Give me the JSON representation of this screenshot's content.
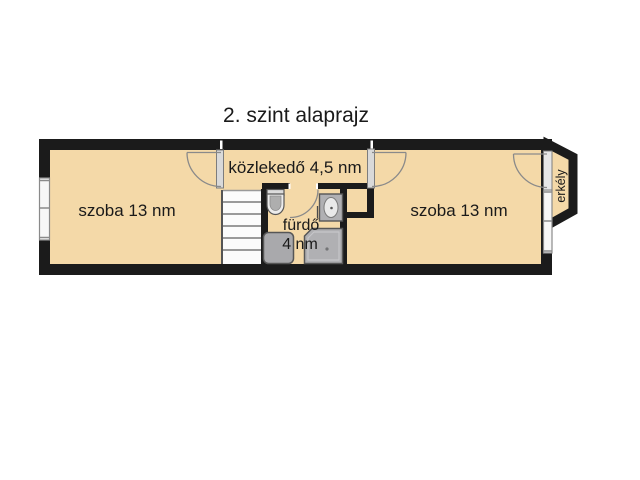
{
  "title": "2. szint alaprajz",
  "floor_plan": {
    "rooms": {
      "left_room": {
        "label": "szoba 13 nm",
        "area_nm": 13
      },
      "corridor": {
        "label": "közlekedő 4,5 nm",
        "area_nm": 4.5
      },
      "bathroom": {
        "label": "fürdő",
        "area_label": "4 nm",
        "area_nm": 4
      },
      "right_room": {
        "label": "szoba 13 nm",
        "area_nm": 13
      },
      "balcony": {
        "label": "erkély"
      }
    },
    "fixtures": {
      "toilet": "toilet-icon",
      "sink": "sink-icon",
      "shower": "shower-icon",
      "washing_machine": "washing-machine-icon",
      "stairs": "stairs-icon"
    },
    "colors": {
      "floor_fill": "#f4d9a8",
      "wall": "#1b1b1b",
      "fixture_gray": "#b0b0b3",
      "line_gray": "#8a8a8a"
    }
  }
}
